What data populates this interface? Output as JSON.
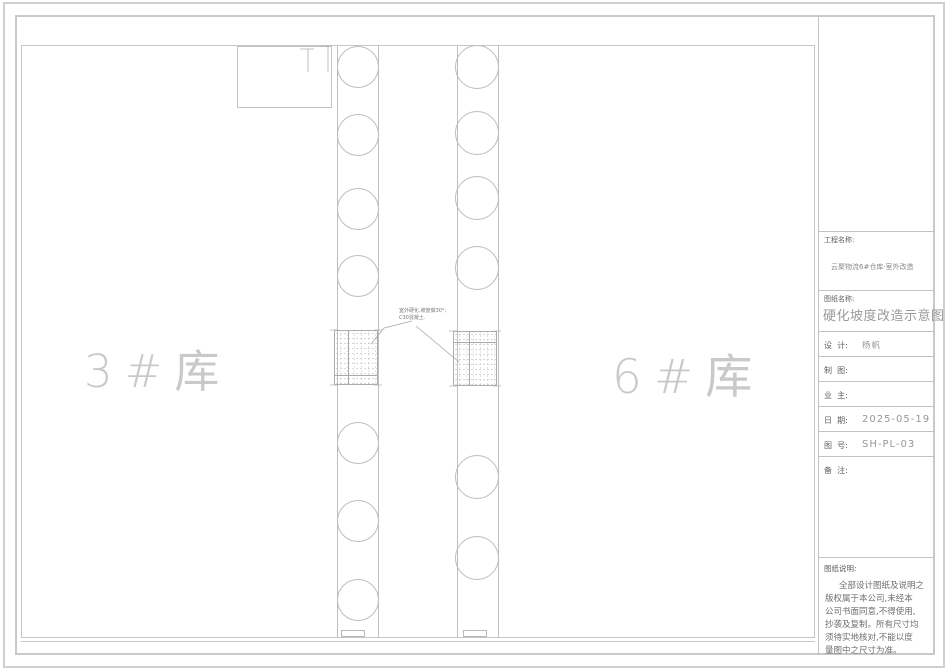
{
  "colors": {
    "frame_line": "#c9c9c9",
    "drawing_line": "#bdbdbd",
    "label_text": "#606060",
    "value_text": "#979797",
    "light_text": "#c9c9c9"
  },
  "drawing": {
    "warehouse_left": "3#库",
    "warehouse_right": "6#库",
    "annotation": {
      "line1": "室外硬化,坡度做30°;",
      "line2": "C30混凝土."
    }
  },
  "titleblock": {
    "project_label": "工程名称:",
    "project_name": "云聚物流6#仓库·室外改造",
    "drawing_label": "图纸名称:",
    "drawing_title": "硬化坡度改造示意图",
    "rows": [
      {
        "label": "设  计:",
        "value": "杨帆"
      },
      {
        "label": "制  图:",
        "value": ""
      },
      {
        "label": "业  主:",
        "value": ""
      },
      {
        "label": "日  期:",
        "value": "2025-05-19"
      },
      {
        "label": "图  号:",
        "value": "SH-PL-03"
      },
      {
        "label": "备  注:",
        "value": ""
      }
    ],
    "notes_label": "图纸说明:",
    "notes": [
      "全部设计图纸及说明之",
      "版权属于本公司,未经本",
      "公司书面同意,不得使用,",
      "抄袭及复制。所有尺寸均",
      "须待实地核对,不能以度",
      "量图中之尺寸为准。"
    ]
  }
}
